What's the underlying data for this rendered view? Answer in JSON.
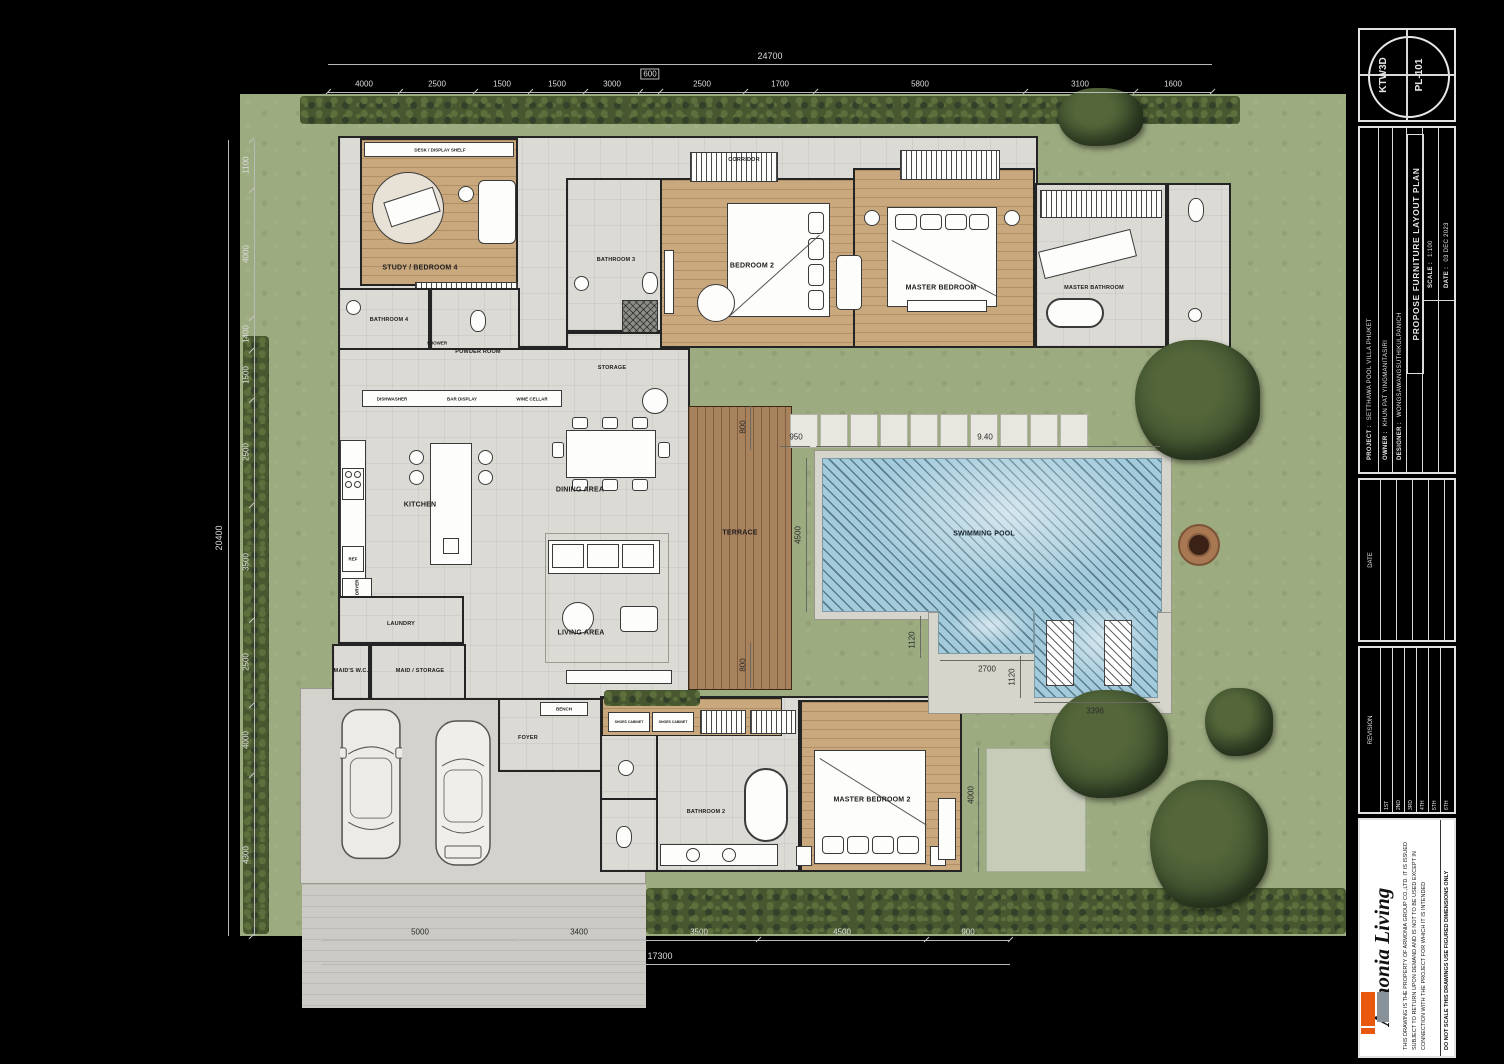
{
  "title_block": {
    "stamp": {
      "code": "KTW3D",
      "sheet": "PL-101"
    },
    "fields": {
      "project_label": "PROJECT :",
      "project": "SETTHAWA POOL VILLA PHUKET",
      "owner_label": "OWNER :",
      "owner": "KHUN PAT YINGMANITASIRI",
      "designer_label": "DESIGNER :",
      "designer": "WONGSAWANGSUTHIKULPANICH",
      "drawing_title": "PROPOSE FURNITURE LAYOUT PLAN",
      "scale_label": "SCALE :",
      "scale": "1:100",
      "date_label": "DATE :",
      "date": "03 DEC 2023"
    },
    "date_section_label": "DATE",
    "revision_label": "REVISION",
    "revisions": [
      "1ST",
      "2ND",
      "3RD",
      "4TH",
      "5TH",
      "6TH"
    ],
    "brand": "Armonia Living",
    "disclaimer": "THIS DRAWING IS THE PROPERTY OF ARMONIA GROUP CO.,LTD. IT IS ISSUED SUBJECT TO RETURN UPON DEMAND AND IS NOT TO BE USED EXCEPT IN CONNECTION WITH THE PROJECT FOR WHICH IT IS INTENDED",
    "note": "DO NOT SCALE THIS DRAWINGS USE FIGURED DIMENSIONS ONLY"
  },
  "rooms": {
    "study": "STUDY / BEDROOM 4",
    "bathroom4": "BATHROOM 4",
    "powder": "POWDER ROOM",
    "bathroom3": "BATHROOM 3",
    "storage": "STORAGE",
    "corridor": "CORRIDOR",
    "bedroom2": "BEDROOM 2",
    "master_bedroom": "MASTER BEDROOM",
    "master_bathroom": "MASTER BATHROOM",
    "kitchen": "KITCHEN",
    "dining": "DINING AREA",
    "living": "LIVING AREA",
    "terrace": "TERRACE",
    "pool": "SWIMMING POOL",
    "laundry": "LAUNDRY",
    "maids_wc": "MAID'S W.C.",
    "maid_storage": "MAID / STORAGE",
    "foyer": "FOYER",
    "bathroom2": "BATHROOM 2",
    "master_bedroom2": "MASTER BEDROOM 2"
  },
  "fixtures": {
    "desk_shelf": "DESK / DISPLAY SHELF",
    "dishwasher": "DISHWASHER",
    "bar_display": "BAR DISPLAY",
    "wine_cellar": "WINE CELLAR",
    "ref": "REF",
    "washer_dryer": "WASHER / DRYER",
    "shower": "SHOWER",
    "bench": "BENCH",
    "shoes_cabinet": "SHOES CABINET"
  },
  "dimensions": {
    "top_overall": "24700",
    "top": [
      "4000",
      "2500",
      "1500",
      "1500",
      "3000",
      "600",
      "2500",
      "1700",
      "5800",
      "3100",
      "1600"
    ],
    "left_overall": "20400",
    "left": [
      "1100",
      "4000",
      "1400",
      "1500",
      "2500",
      "3500",
      "2500",
      "4000",
      "4300"
    ],
    "bottom_overall": "17300",
    "bottom": [
      "5000",
      "3400",
      "3500",
      "4500",
      "900"
    ],
    "pool_length": "9.40",
    "pool_width": "4500",
    "stepping": "950",
    "terrace_top": "800",
    "terrace_bottom": "800",
    "notch_a": "1120",
    "notch_b": "2700",
    "notch_c": "1120",
    "lounger": "3396",
    "patio": "4000"
  },
  "colors": {
    "grass": "#9dab80",
    "hedge": "#48572f",
    "wood": "#c9a87e",
    "deck": "#a8815d",
    "water": "#a3cbdc",
    "tile": "#dbdad4",
    "brand_orange": "#e8590f",
    "brand_gray": "#8a9299"
  }
}
